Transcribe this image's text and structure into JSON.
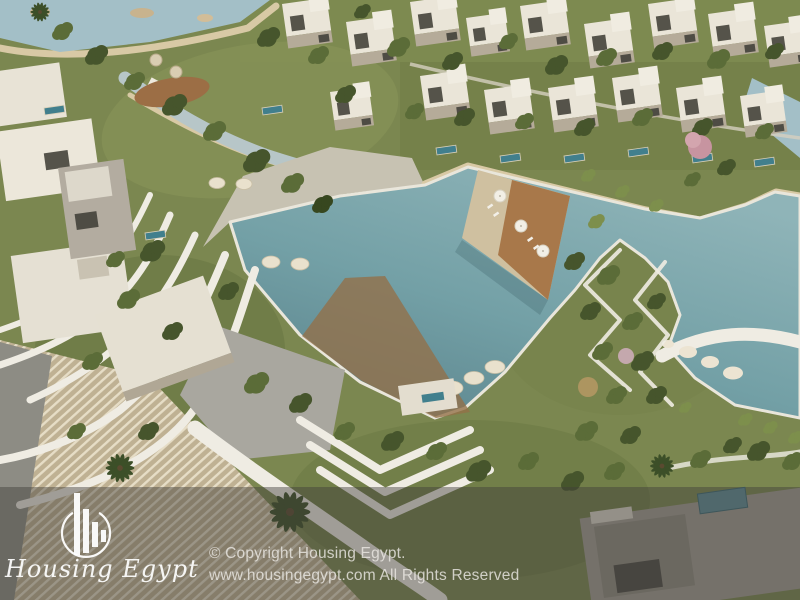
{
  "watermark": {
    "brand": "Housing Egypt",
    "logo_icon": "building-bars-in-circle-icon",
    "copyright_line1": "© Copyright Housing Egypt.",
    "copyright_line2": "www.housingegypt.com All Rights Reserved"
  },
  "scene": {
    "colors": {
      "lagoon": "#6f9aa0",
      "lagoon_light": "#a3bfc7",
      "grass": "#7b8750",
      "sand": "#d8c9a5",
      "deck_wood": "#a8784a",
      "villa_white": "#eae5d8",
      "path_white": "#efece3",
      "stone_plaza": "#a9a79f",
      "overlay": "rgba(64,62,58,0.45)"
    }
  }
}
